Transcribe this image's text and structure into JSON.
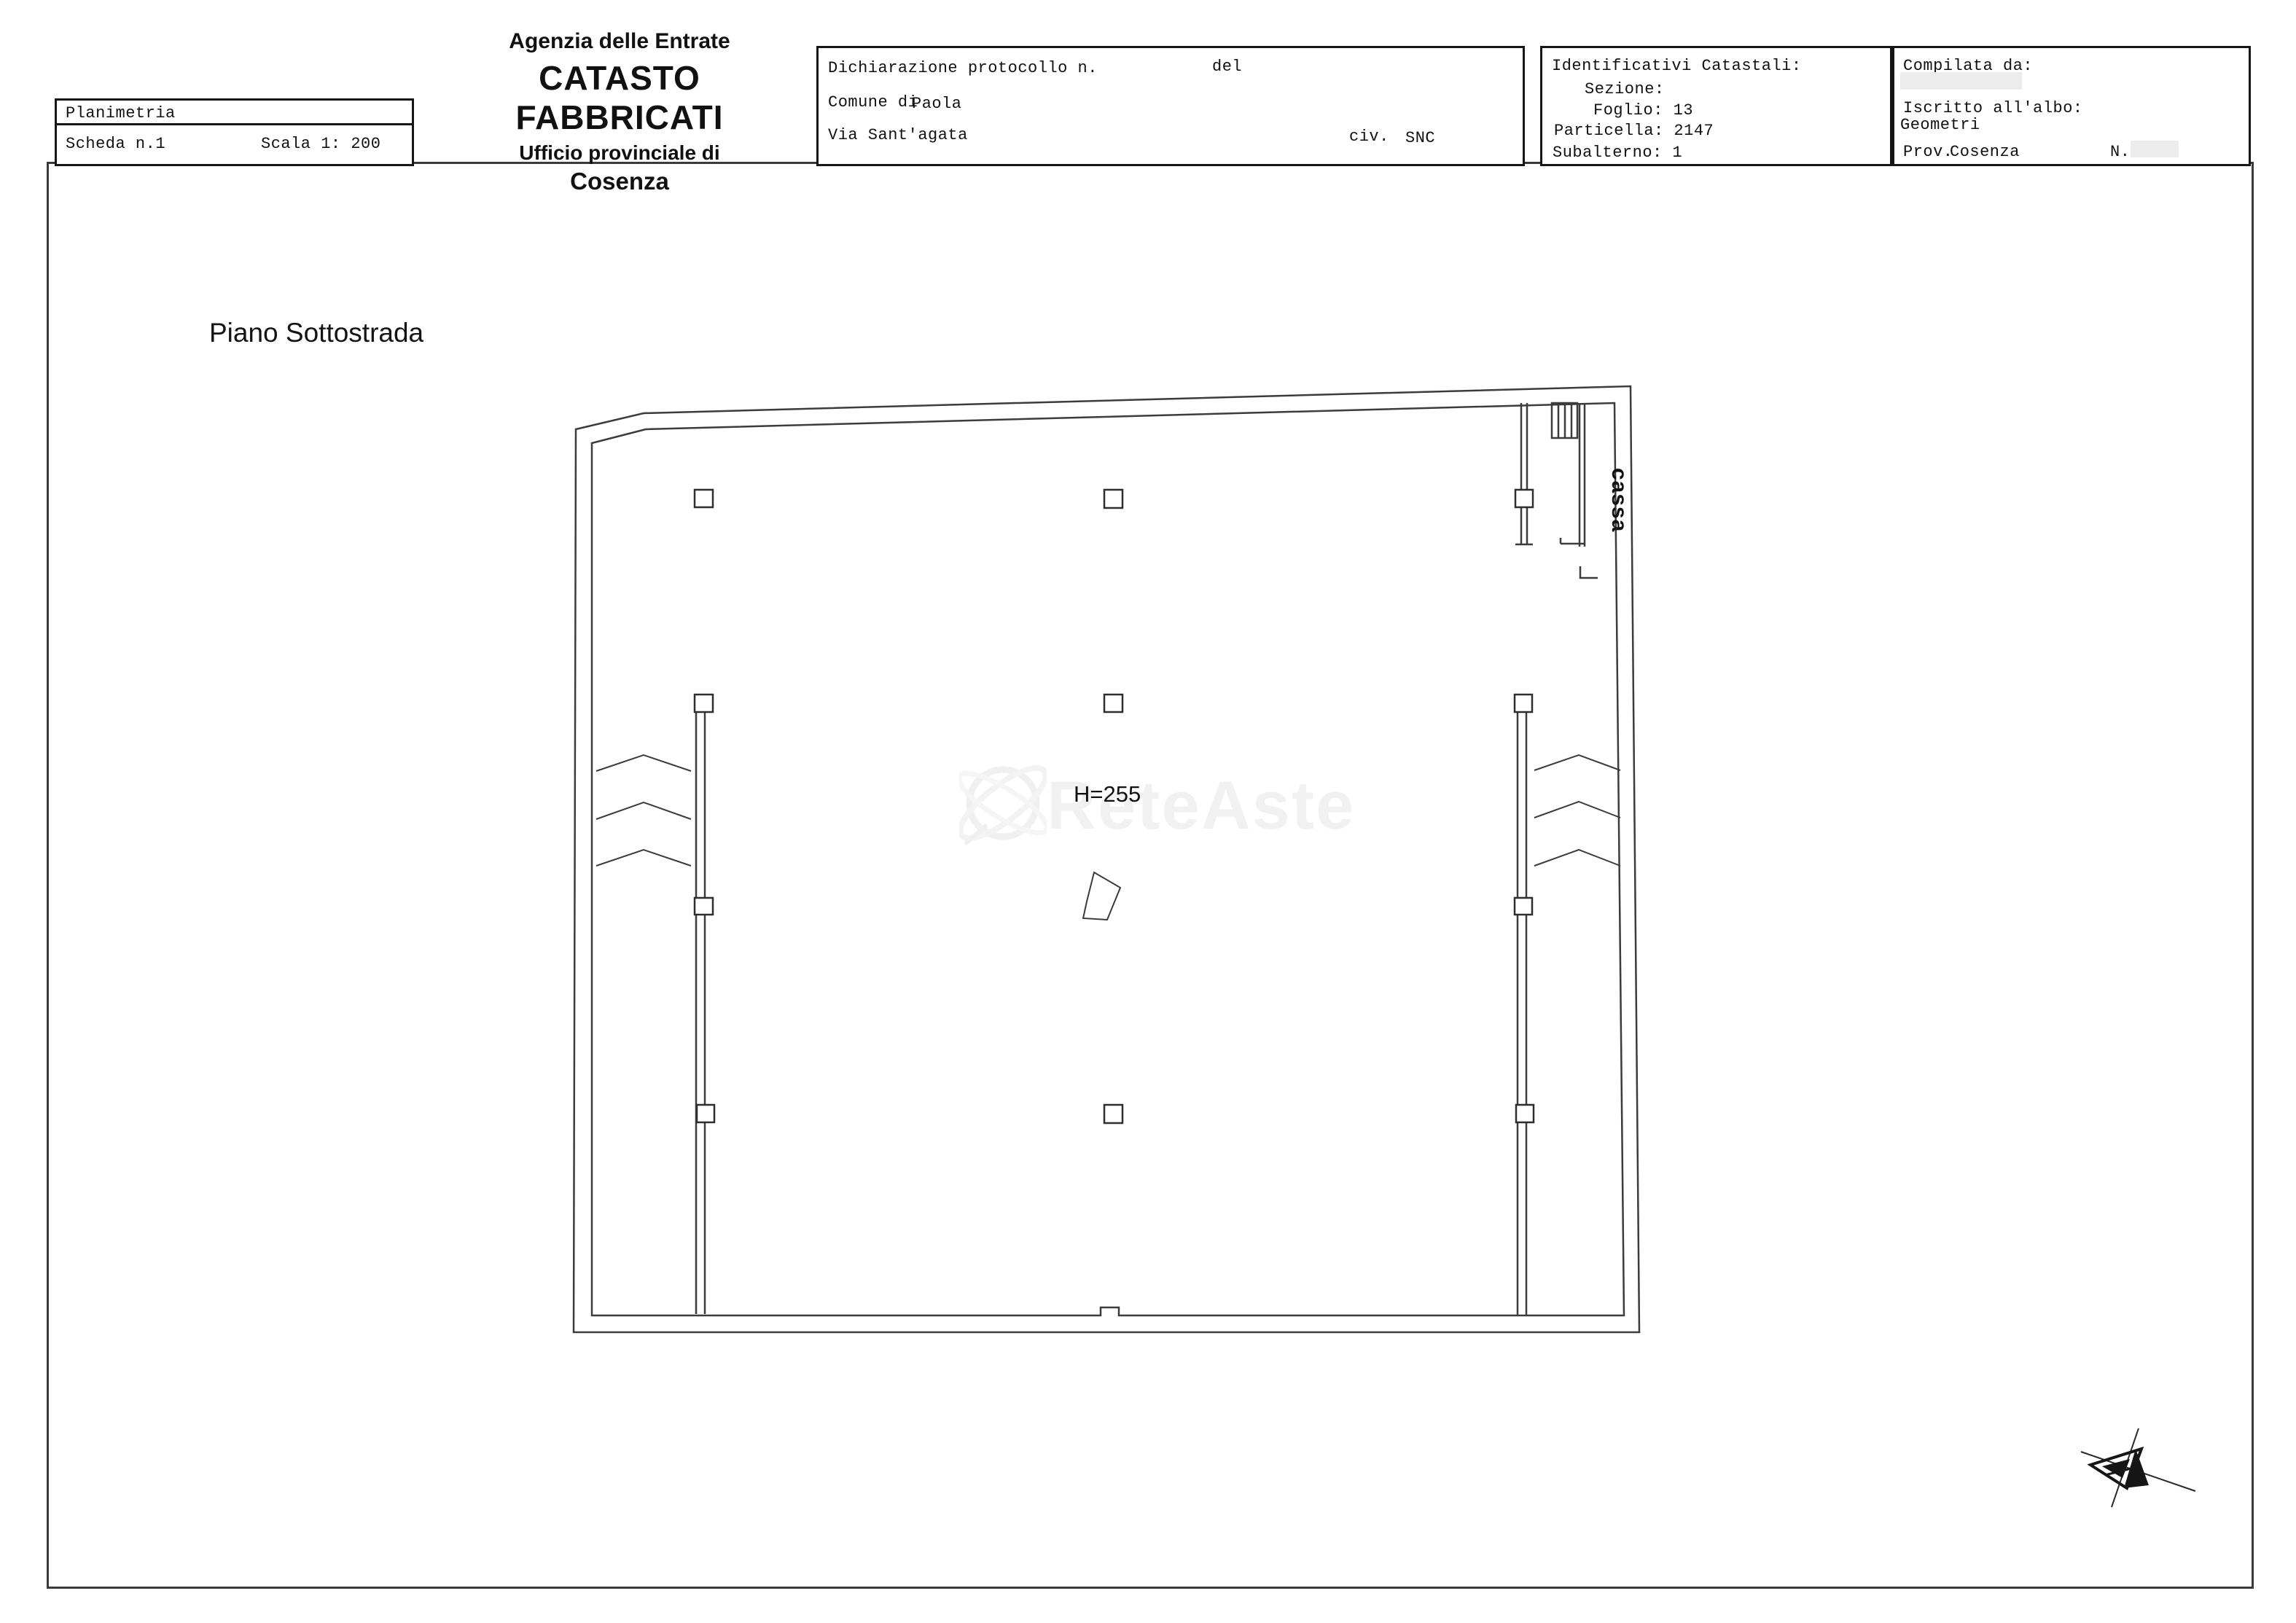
{
  "header": {
    "left_box": {
      "title": "Planimetria",
      "scheda": "Scheda n.1",
      "scala": "Scala 1: 200"
    },
    "agency": {
      "line1": "Agenzia delle Entrate",
      "line2": "CATASTO FABBRICATI",
      "line3": "Ufficio provinciale di",
      "line4": "Cosenza"
    },
    "declaration": {
      "protocol_label": "Dichiarazione protocollo n.",
      "del_label": "del",
      "comune_label": "Comune di",
      "comune_value": "Paola",
      "street": "Via Sant'agata",
      "civ_label": "civ.",
      "civ_value": "SNC"
    },
    "cadastral": {
      "title": "Identificativi Catastali:",
      "sezione": "Sezione:",
      "foglio": "Foglio: 13",
      "particella": "Particella: 2147",
      "subalterno": "Subalterno: 1"
    },
    "compiler": {
      "title": "Compilata da:",
      "albo_label": "Iscritto all'albo:",
      "albo_value": "Geometri",
      "prov_label": "Prov.",
      "prov_value": "Cosenza",
      "n_label": "N."
    }
  },
  "plan": {
    "floor_label": "Piano Sottostrada",
    "height_label": "H=255",
    "room_label": "cassa",
    "watermark": "ReteAste"
  },
  "colors": {
    "wall": "#3c3c3c",
    "text": "#111111",
    "redaction": "#ececec",
    "watermark": "#f1f1f1"
  }
}
